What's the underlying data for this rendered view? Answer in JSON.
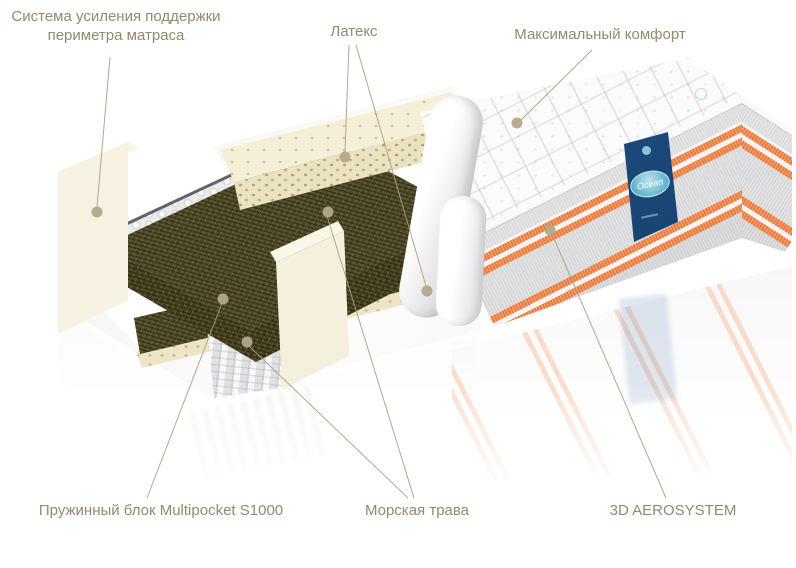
{
  "diagram": {
    "kind": "mattress cutaway product diagram",
    "layers_shown": [
      "quilted cover",
      "latex",
      "sea grass",
      "pocket spring block with foam perimeter",
      "sea grass",
      "latex",
      "base cover"
    ]
  },
  "brand": {
    "side_label_text": "Ocean"
  },
  "colors": {
    "line": "#ac9f81",
    "dot": "#b3a88a",
    "label_text": "#95896e",
    "orange_stripe": "#ed7b3c",
    "label_blue": "#1d4b80",
    "oval_blue": "#57b1cc",
    "seagrass_green": "#4e4929",
    "latex_cream": "#ece3c0",
    "foam_cream": "#f4efdc"
  },
  "callouts": [
    {
      "id": "perimeter-support",
      "text": "Система усиления поддержки периметра матраса",
      "lines": [
        [
          110,
          57,
          97,
          207
        ]
      ],
      "dots": [
        [
          97,
          212
        ]
      ]
    },
    {
      "id": "latex",
      "text": "Латекс",
      "lines": [
        [
          349,
          45,
          345,
          152
        ],
        [
          356,
          45,
          426,
          286
        ]
      ],
      "dots": [
        [
          345,
          157
        ],
        [
          427,
          291
        ]
      ]
    },
    {
      "id": "max-comfort",
      "text": "Максимальный комфорт",
      "lines": [
        [
          592,
          50,
          520,
          121
        ]
      ],
      "dots": [
        [
          517,
          123
        ]
      ]
    },
    {
      "id": "spring-block",
      "text": "Пружинный блок Multipocket S1000",
      "lines": [
        [
          147,
          498,
          222,
          303
        ]
      ],
      "dots": [
        [
          223,
          299
        ]
      ]
    },
    {
      "id": "sea-grass",
      "text": "Морская трава",
      "lines": [
        [
          408,
          498,
          249,
          346
        ],
        [
          414,
          498,
          327,
          216
        ]
      ],
      "dots": [
        [
          247,
          342
        ],
        [
          328,
          212
        ]
      ]
    },
    {
      "id": "aerosystem",
      "text": "3D AEROSYSTEM",
      "lines": [
        [
          666,
          498,
          552,
          234
        ]
      ],
      "dots": [
        [
          550,
          230
        ]
      ]
    }
  ]
}
